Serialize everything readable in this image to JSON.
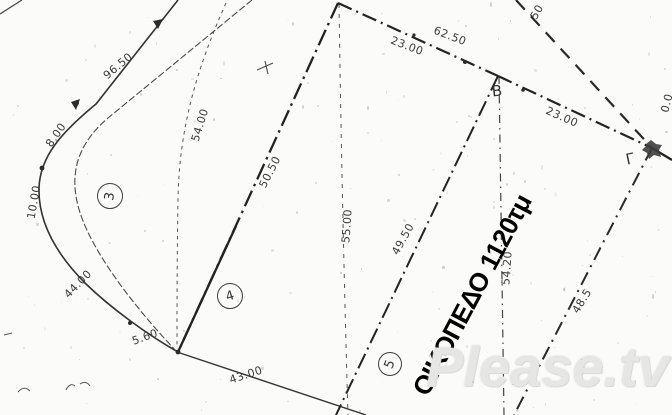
{
  "drawing": {
    "title": "ΟΙΚΟΠΕΔΟ 1120τμ",
    "watermark": "Please.tv",
    "ink_color": "#2d2d2d",
    "paper_color": "#fbfbfa",
    "vertex_labels": [
      {
        "text": "Β",
        "x": 497,
        "y": 91,
        "rot": -6
      },
      {
        "text": "Γ",
        "x": 630,
        "y": 159,
        "rot": -12
      }
    ],
    "parcel_numbers": [
      {
        "text": "3",
        "x": 110,
        "y": 196,
        "r": 12,
        "rot": -80
      },
      {
        "text": "4",
        "x": 230,
        "y": 296,
        "r": 12,
        "rot": -18
      },
      {
        "text": "5",
        "x": 390,
        "y": 364,
        "r": 11,
        "rot": -68
      }
    ],
    "measurements": [
      {
        "text": "96.50",
        "x": 118,
        "y": 66,
        "rot": -40
      },
      {
        "text": "8.00",
        "x": 56,
        "y": 135,
        "rot": -55
      },
      {
        "text": "10.00",
        "x": 34,
        "y": 202,
        "rot": -80
      },
      {
        "text": "44.00",
        "x": 78,
        "y": 284,
        "rot": -46
      },
      {
        "text": "5.60",
        "x": 145,
        "y": 337,
        "rot": -20
      },
      {
        "text": "43.00",
        "x": 246,
        "y": 375,
        "rot": -18
      },
      {
        "text": "54.00",
        "x": 200,
        "y": 125,
        "rot": -73
      },
      {
        "text": "50.50",
        "x": 270,
        "y": 172,
        "rot": -63
      },
      {
        "text": "55.00",
        "x": 347,
        "y": 226,
        "rot": -86
      },
      {
        "text": "23.00",
        "x": 407,
        "y": 46,
        "rot": 21
      },
      {
        "text": "62.50",
        "x": 450,
        "y": 36,
        "rot": 21
      },
      {
        "text": "23.00",
        "x": 562,
        "y": 117,
        "rot": 24
      },
      {
        "text": "54.20",
        "x": 507,
        "y": 268,
        "rot": -86
      },
      {
        "text": "49.50",
        "x": 403,
        "y": 239,
        "rot": -61
      },
      {
        "text": "48.5",
        "x": 582,
        "y": 301,
        "rot": -58
      },
      {
        "text": "50",
        "x": 537,
        "y": 12,
        "rot": -60
      },
      {
        "text": "0.0",
        "x": 667,
        "y": 103,
        "rot": -76
      }
    ]
  }
}
